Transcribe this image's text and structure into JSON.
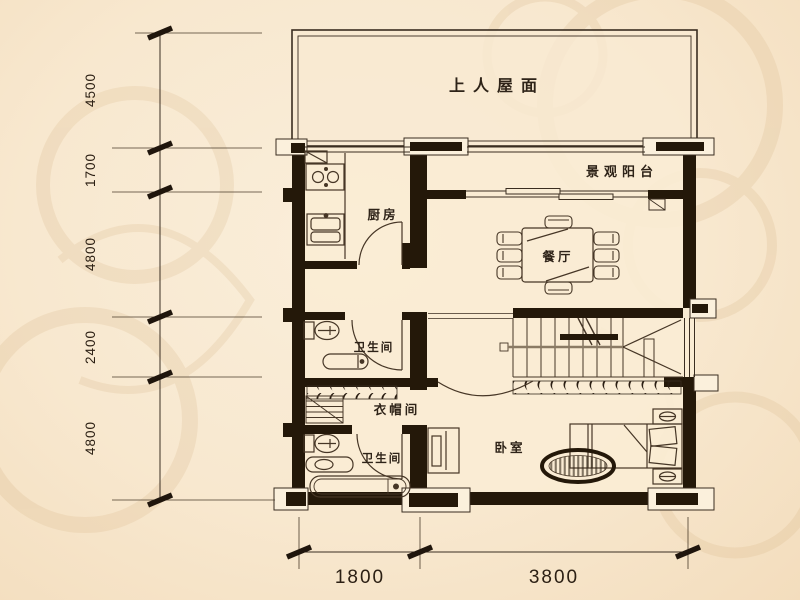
{
  "plan": {
    "rooms": {
      "roof_terrace": "上人屋面",
      "balcony": "景观阳台",
      "kitchen": "厨房",
      "dining": "餐厅",
      "bathroom_upper": "卫生间",
      "cloakroom": "衣帽间",
      "bathroom_lower": "卫生间",
      "bedroom": "卧室"
    },
    "dimensions": {
      "left": [
        "4500",
        "1700",
        "4800",
        "2400",
        "4800"
      ],
      "bottom": [
        "1800",
        "3800"
      ]
    },
    "colors": {
      "background": "#f8e8cf",
      "wall": "#241809",
      "line": "#463626",
      "text": "#2e2318"
    }
  }
}
